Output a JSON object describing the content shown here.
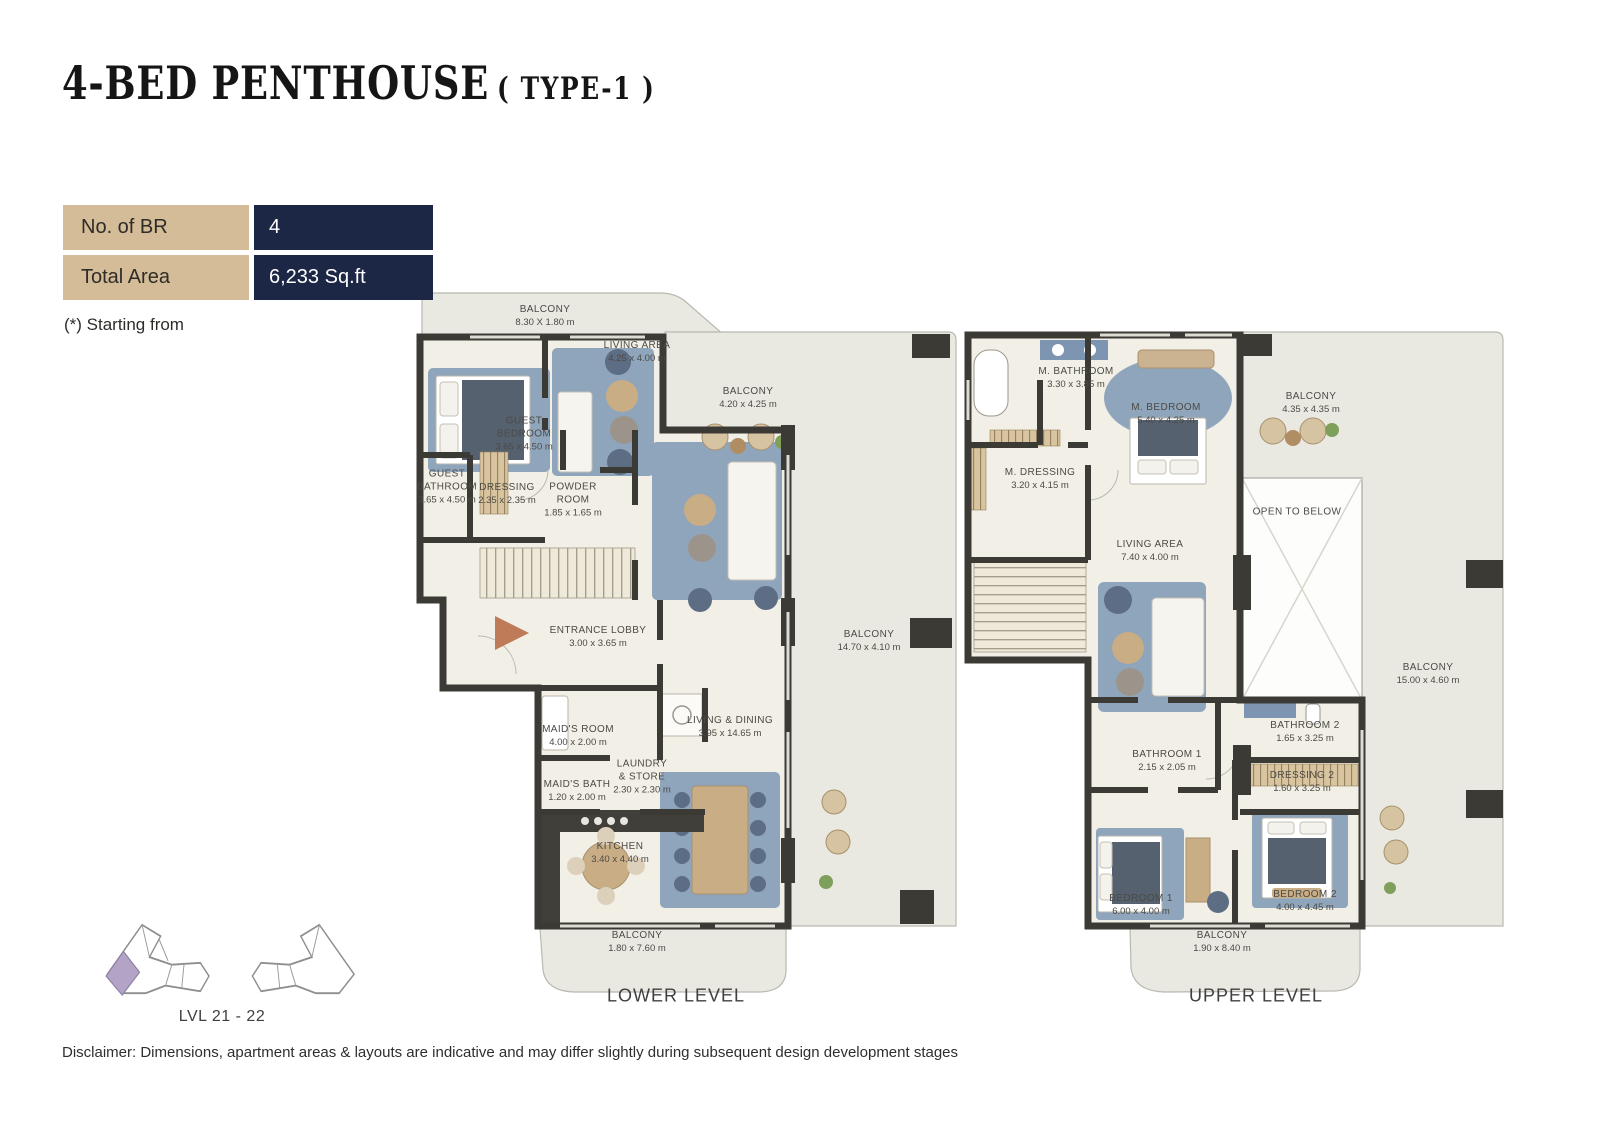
{
  "title": {
    "main": "4-BED PENTHOUSE",
    "type": "( TYPE-1 )"
  },
  "info_table": {
    "rows": [
      {
        "label": "No. of BR",
        "value": "4"
      },
      {
        "label": "Total Area",
        "value": "6,233 Sq.ft"
      }
    ],
    "note": "(*) Starting from",
    "label_bg": "#d3bc97",
    "value_bg": "#1c2645"
  },
  "key_plan": {
    "level_label": "LVL 21 - 22",
    "highlight_color": "#b3a4c7"
  },
  "levels": [
    {
      "name": "LOWER LEVEL",
      "rooms": [
        {
          "name": "BALCONY",
          "dims": "8.30 X 1.80 m"
        },
        {
          "name": "LIVING AREA",
          "dims": "4.25 x 4.00 m"
        },
        {
          "name": "BALCONY",
          "dims": "4.20 x 4.25 m"
        },
        {
          "name": "GUEST BEDROOM",
          "dims": "3.65 x 4.50 m"
        },
        {
          "name": "GUEST BATHROOM",
          "dims": "3.65 x 4.50 m"
        },
        {
          "name": "DRESSING",
          "dims": "2.35 x 2.35 m"
        },
        {
          "name": "POWDER ROOM",
          "dims": "1.85 x 1.65 m"
        },
        {
          "name": "ENTRANCE LOBBY",
          "dims": "3.00 x 3.65 m"
        },
        {
          "name": "BALCONY",
          "dims": "14.70 x 4.10 m"
        },
        {
          "name": "LIVING & DINING",
          "dims": "3.95 x 14.65 m"
        },
        {
          "name": "MAID'S ROOM",
          "dims": "4.00 x 2.00 m"
        },
        {
          "name": "LAUNDRY & STORE",
          "dims": "2.30 x 2.30 m"
        },
        {
          "name": "MAID'S BATH",
          "dims": "1.20 x 2.00 m"
        },
        {
          "name": "KITCHEN",
          "dims": "3.40 x 4.40 m"
        },
        {
          "name": "BALCONY",
          "dims": "1.80 x 7.60 m"
        }
      ]
    },
    {
      "name": "UPPER LEVEL",
      "rooms": [
        {
          "name": "M. BATHROOM",
          "dims": "3.30 x 3.85 m"
        },
        {
          "name": "M. BEDROOM",
          "dims": "5.40 x 4.25 m"
        },
        {
          "name": "BALCONY",
          "dims": "4.35 x 4.35 m"
        },
        {
          "name": "M. DRESSING",
          "dims": "3.20 x 4.15 m"
        },
        {
          "name": "OPEN TO BELOW",
          "dims": ""
        },
        {
          "name": "LIVING AREA",
          "dims": "7.40 x 4.00 m"
        },
        {
          "name": "BALCONY",
          "dims": "15.00 x 4.60 m"
        },
        {
          "name": "BATHROOM 2",
          "dims": "1.65 x 3.25 m"
        },
        {
          "name": "BATHROOM 1",
          "dims": "2.15 x 2.05 m"
        },
        {
          "name": "DRESSING 2",
          "dims": "1.60 x 3.25 m"
        },
        {
          "name": "BEDROOM 1",
          "dims": "6.00 x 4.00 m"
        },
        {
          "name": "BEDROOM 2",
          "dims": "4.00 x 4.45 m"
        },
        {
          "name": "BALCONY",
          "dims": "1.90 x 8.40 m"
        }
      ]
    }
  ],
  "colors": {
    "wall": "#3c3a35",
    "interior_floor": "#f2efe6",
    "balcony_floor": "#e9e9e1",
    "rug_blue": "#8fa5bc",
    "wood_tan": "#c9ad85",
    "entrance_arrow": "#bf7a57",
    "navy": "#1c2645",
    "tan_cell": "#d3bc97"
  },
  "disclaimer": "Disclaimer: Dimensions, apartment areas & layouts are indicative and may differ slightly during subsequent design development stages"
}
